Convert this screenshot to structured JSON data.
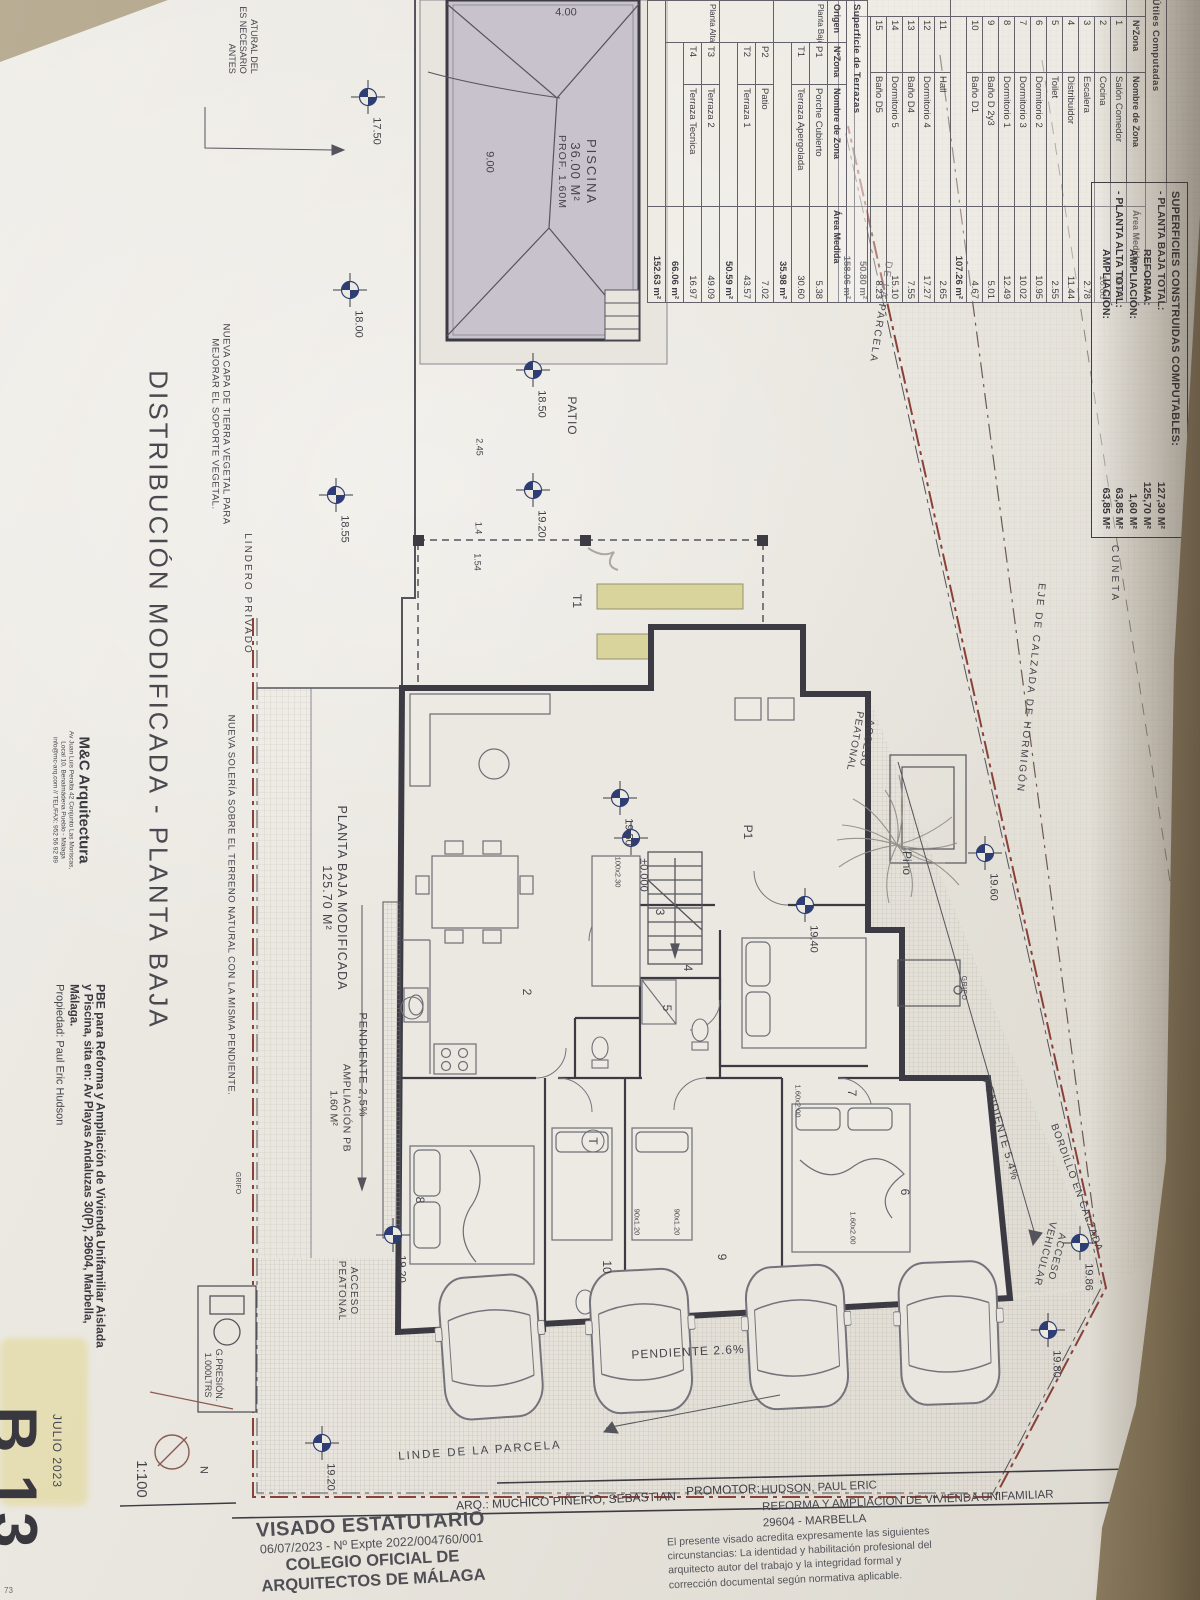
{
  "titles": {
    "drawing_title": "DISTRIBUCIÓN MODIFICADA - PLANTA BAJA"
  },
  "tables": {
    "useful_areas": {
      "caption": "Superficies Útiles Computadas",
      "headers": [
        "",
        "NºZona",
        "Nombre de Zona",
        "Área Medida"
      ],
      "groups": [
        {
          "name": "Planta Baja",
          "rows": [
            [
              "1",
              "Salón Comedor",
              "36.47"
            ],
            [
              "2",
              "Cocina",
              "10.88"
            ],
            [
              "3",
              "Escalera",
              "2.78"
            ],
            [
              "4",
              "Distribuidor",
              "11.44"
            ],
            [
              "5",
              "Toilet",
              "2.55"
            ],
            [
              "6",
              "Dormitorio 2",
              "10.95"
            ],
            [
              "7",
              "Dormitorio 3",
              "10.02"
            ],
            [
              "8",
              "Dormitorio 1",
              "12.49"
            ],
            [
              "9",
              "Baño D 2y3",
              "5.01"
            ],
            [
              "10",
              "Baño D1",
              "4.67"
            ]
          ],
          "subtotal": "107.26 m²"
        },
        {
          "name": "Planta Alta",
          "rows": [
            [
              "11",
              "Hall",
              "2.65"
            ],
            [
              "12",
              "Dormitorio 4",
              "17.27"
            ],
            [
              "13",
              "Baño D4",
              "7.55"
            ],
            [
              "14",
              "Dormitorio 5",
              "15.10"
            ],
            [
              "15",
              "Baño D5",
              "8.23"
            ]
          ],
          "subtotal": "50.80 m²"
        }
      ],
      "total": "158.06 m²"
    },
    "terraces": {
      "caption": "Superficie de Terrazas",
      "headers": [
        "Origen",
        "NºZona",
        "Nombre de Zona",
        "Área Medida"
      ],
      "groups": [
        {
          "name": "Planta Baja",
          "rows": [
            [
              "P1",
              "Porche Cubierto",
              "5.38"
            ],
            [
              "T1",
              "Terraza Apergolada",
              "30.60"
            ]
          ],
          "subtotal": "35.98 m²"
        },
        {
          "name": "",
          "rows": [
            [
              "P2",
              "Patio",
              "7.02"
            ],
            [
              "T2",
              "Terraza 1",
              "43.57"
            ]
          ],
          "subtotal": "50.59 m²"
        },
        {
          "name": "Planta Alta",
          "rows": [
            [
              "T3",
              "Terraza 2",
              "49.09"
            ],
            [
              "T4",
              "Terraza Tecnica",
              "16.97"
            ]
          ],
          "subtotal": "66.06 m²"
        }
      ],
      "total": "152.63 m²"
    }
  },
  "built_areas": {
    "title": "SUPERFICIES CONSTRUIDAS COMPUTABLES:",
    "rows": [
      {
        "label": "- PLANTA BAJA TOTAL:",
        "value": "127,30 M²",
        "indent": false
      },
      {
        "label": "REFORMA:",
        "value": "125,70 M²",
        "indent": true
      },
      {
        "label": "AMPLIACIÓN:",
        "value": "1,60 M²",
        "indent": true
      },
      {
        "label": "- PLANTA ALTA TOTAL:",
        "value": "63,85 M²",
        "indent": false
      },
      {
        "label": "AMPLIACIÓN:",
        "value": "63,85 M²",
        "indent": true
      }
    ]
  },
  "pool": {
    "name": "PISCINA",
    "area": "36.00 M²",
    "depth": "PROF. 1.60M",
    "width_dim": "4.00",
    "length_dim": "9.00"
  },
  "site_labels": {
    "cuneta": "CUNETA",
    "eje": "EJE DE CALZADA DE HORMIGÓN",
    "de_la_parcela": "DE LA PARCELA",
    "acceso_peatonal": [
      "ACCESO",
      "PEATONAL"
    ],
    "acceso_vehicular": [
      "ACCESO",
      "VEHICULAR"
    ],
    "pino": "Pino",
    "grifo": "GRIFO",
    "bordillo": "BORDILLO EN CALZADA",
    "pendiente_ramp": "PENDIENTE 5.4%",
    "pendiente_drive": "PENDIENTE 2.6%",
    "pendiente_interior": "PENDIENTE 2,5%",
    "linde": "LINDE DE LA PARCELA",
    "lindero": "LINDERO PRIVADO",
    "nueva_capa": [
      "NUEVA CAPA DE TIERRA VEGETAL PARA",
      "MEJORAR EL SOPORTE VEGETAL."
    ],
    "nueva_soleria": "NUEVA SOLERÍA SOBRE EL TERRENO NATURAL CON LA MISMA PENDIENTE.",
    "partial_note": [
      "ATURAL DEL",
      "ES NECESARIO",
      "ANTES"
    ],
    "gpresion": [
      "G.PRESIÓN.",
      "1.000LTRS"
    ],
    "patio": "PATIO"
  },
  "plan": {
    "modified_label": [
      "PLANTA BAJA MODIFICADA",
      "125.70 M²"
    ],
    "ampliacion_label": [
      "AMPLIACIÓN PB",
      "1.60 M²"
    ],
    "room_numbers": [
      "2",
      "3",
      "4",
      "5",
      "6",
      "7",
      "8",
      "9",
      "10",
      "T",
      "P1",
      "T1"
    ],
    "fixtures": [
      "1.60x2.00",
      "1.60x2.00",
      "90x1.20",
      "90x1.20",
      "100x2.30"
    ]
  },
  "levels": [
    "17.50",
    "18.00",
    "18.50",
    "19.20",
    "18.55",
    "19.50",
    "±0.000",
    "19.40",
    "19.60",
    "19.20",
    "19.20",
    "19.86",
    "19.80"
  ],
  "dims": [
    "2.45",
    "1.4",
    "1.54"
  ],
  "scale": "1:100",
  "north": "N",
  "page": {
    "code": "B 13",
    "date": "JULIO 2023",
    "fragment": "73"
  },
  "stamp": {
    "line1": "VISADO ESTATUTARIO",
    "line2": "06/07/2023 - Nº Expte 2022/004760/001",
    "line3": "COLEGIO OFICIAL DE",
    "line4": "ARQUITECTOS DE MÁLAGA",
    "paragraph": [
      "El presente visado acredita expresamente las siguientes",
      "circunstancias: La identidad y habilitación profesional del",
      "arquitecto autor del trabajo y la integridad formal y",
      "corrección documental según normativa aplicable."
    ]
  },
  "credits": {
    "architect": "ARQ.: MUCHICO PIÑEIRO, SEBASTIAN",
    "promoter_label": "PROMOTOR:",
    "promoter": "HUDSON, PAUL ERIC",
    "project": "REFORMA Y AMPLIACION DE VIVIENDA UNIFAMILIAR",
    "city": "29604 - MARBELLA"
  },
  "firm": {
    "name": "M&C Arquitectura",
    "address1": "Av Juan Luis Peralta 42 Conjunto Las Moriscas,",
    "address2": "Local 10, Benalmádena Pueblo - Málaga",
    "contact": "info@mc-arq.com // TEL/FAX: 952 56 92 89"
  },
  "project_block": {
    "line1": "PBE para Reforma y Ampliación de Vivienda Unifamiliar Aislada",
    "line2": "y Piscina, sita en: Av Playas Andaluzas 30(P), 29604, Marbella,",
    "line3": "Málaga.",
    "line4": "Propiedad: Paul Eric Hudson"
  },
  "colors": {
    "marker": "#2e3e74",
    "boundary": "#8a4138",
    "pergola": "#d9d49b",
    "pool": "#c7c2cb"
  }
}
